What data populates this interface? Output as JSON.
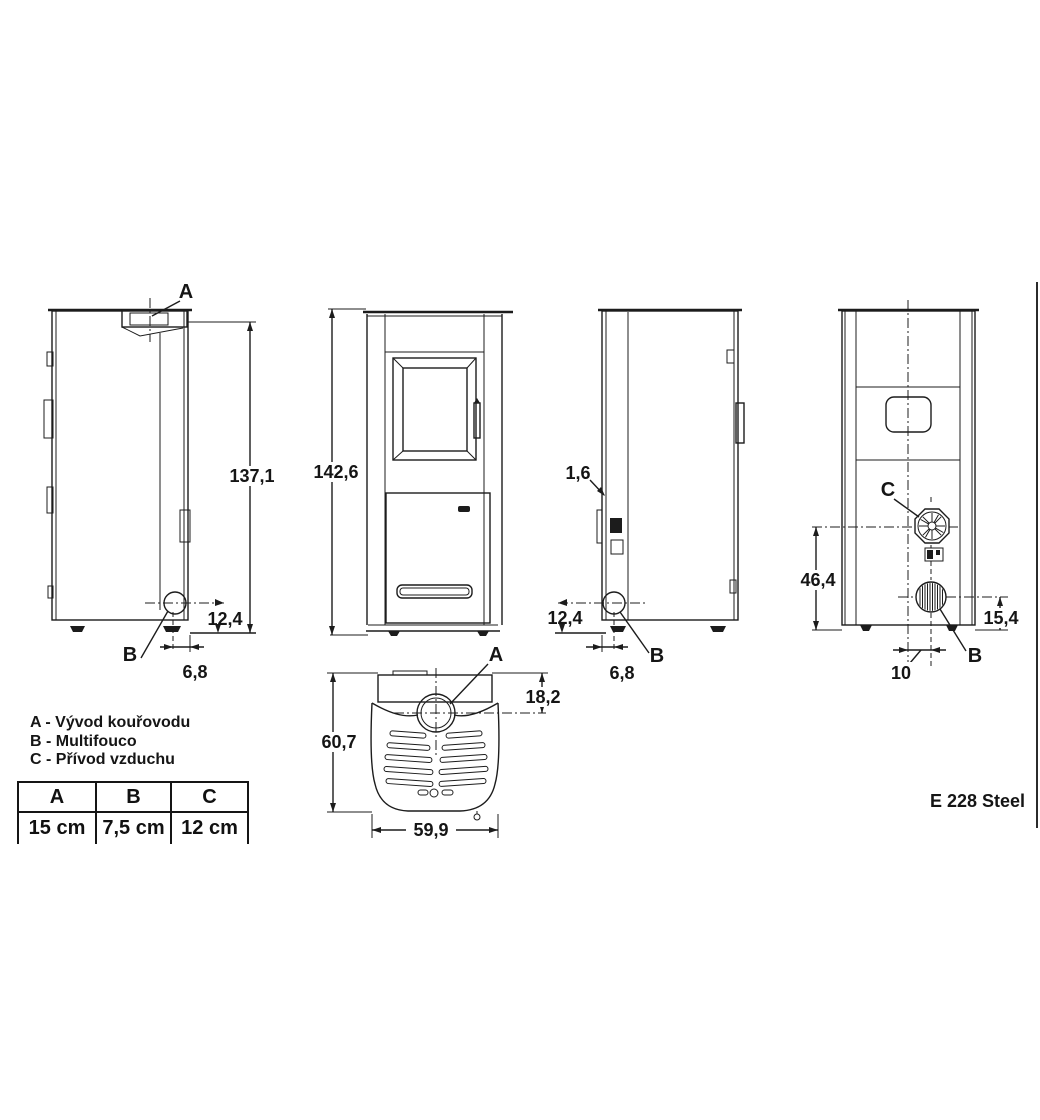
{
  "model": "E 228 Steel",
  "legend": [
    {
      "key": "A",
      "text": "A - Vývod kouřovodu"
    },
    {
      "key": "B",
      "text": "B - Multifouco"
    },
    {
      "key": "C",
      "text": "C - Přívod vzduchu"
    }
  ],
  "table": {
    "headers": [
      "A",
      "B",
      "C"
    ],
    "values": [
      "15 cm",
      "7,5 cm",
      "12 cm"
    ]
  },
  "views": {
    "left_side": {
      "flue_label": "A",
      "multifuoco_label": "B",
      "height_to_flue": "137,1",
      "multifuoco_height": "12,4",
      "multifuoco_from_back": "6,8"
    },
    "front": {
      "overall_height": "142,6"
    },
    "right_side": {
      "wall_thickness": "1,6",
      "multifuoco_height": "12,4",
      "multifuoco_from_back": "6,8",
      "multifuoco_label": "B"
    },
    "rear": {
      "air_label": "C",
      "flue_label": "B",
      "air_inlet_height": "46,4",
      "flue_height": "15,4",
      "flue_offset_from_center": "10"
    },
    "top": {
      "flue_label": "A",
      "depth": "60,7",
      "width": "59,9",
      "flue_from_back": "18,2"
    }
  }
}
